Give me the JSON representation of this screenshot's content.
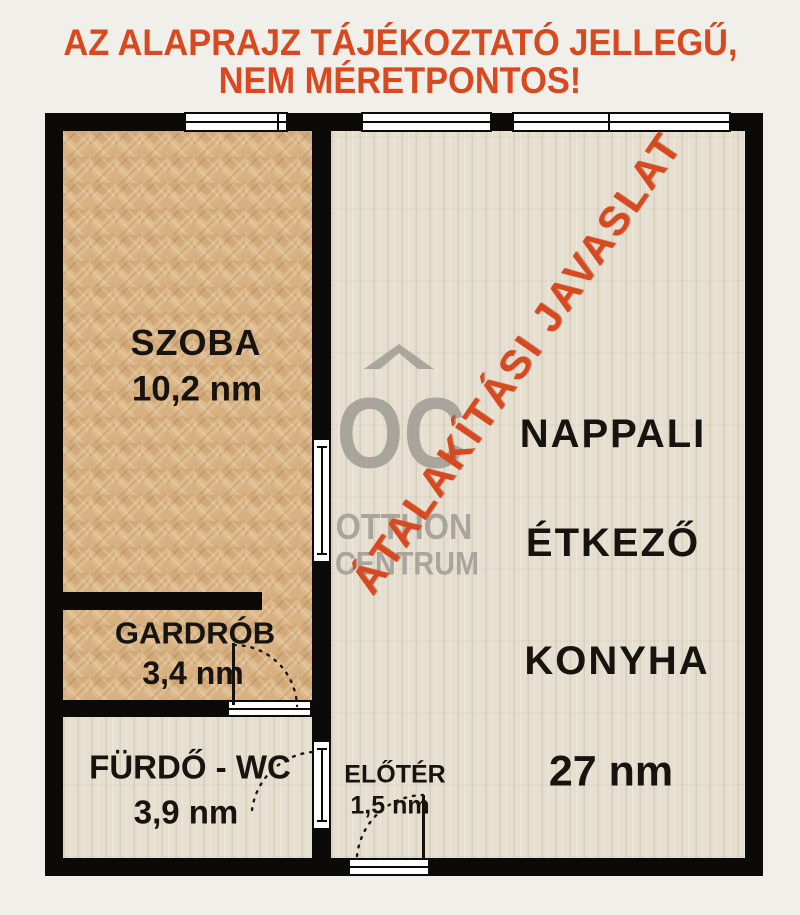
{
  "header": {
    "line1": "AZ ALAPRAJZ TÁJÉKOZTATÓ JELLEGŰ,",
    "line2": "NEM MÉRETPONTOS!"
  },
  "overlay": {
    "stamp": "ÁTALAKÍTÁSI JAVASLAT"
  },
  "watermark": {
    "monogram": "OC",
    "line1": "OTTHON",
    "line2": "CENTRUM"
  },
  "rooms": {
    "szoba": {
      "name": "SZOBA",
      "area": "10,2 nm"
    },
    "gardrob": {
      "name": "GARDRÓB",
      "area": "3,4 nm"
    },
    "furdo": {
      "name": "FÜRDŐ - WC",
      "area": "3,9 nm"
    },
    "eloter": {
      "name": "ELŐTÉR",
      "area": "1,5 nm"
    },
    "nappali": {
      "name1": "NAPPALI",
      "name2": "ÉTKEZŐ",
      "name3": "KONYHA",
      "area": "27 nm"
    }
  },
  "colors": {
    "accent_red": "#D8491F",
    "wall_black": "#0B0A08",
    "parquet_tan": "#DEBB8D",
    "tile_cream": "#E6DFD0",
    "watermark_gray": "#A09C93",
    "page_background": "#F1EFEA"
  }
}
